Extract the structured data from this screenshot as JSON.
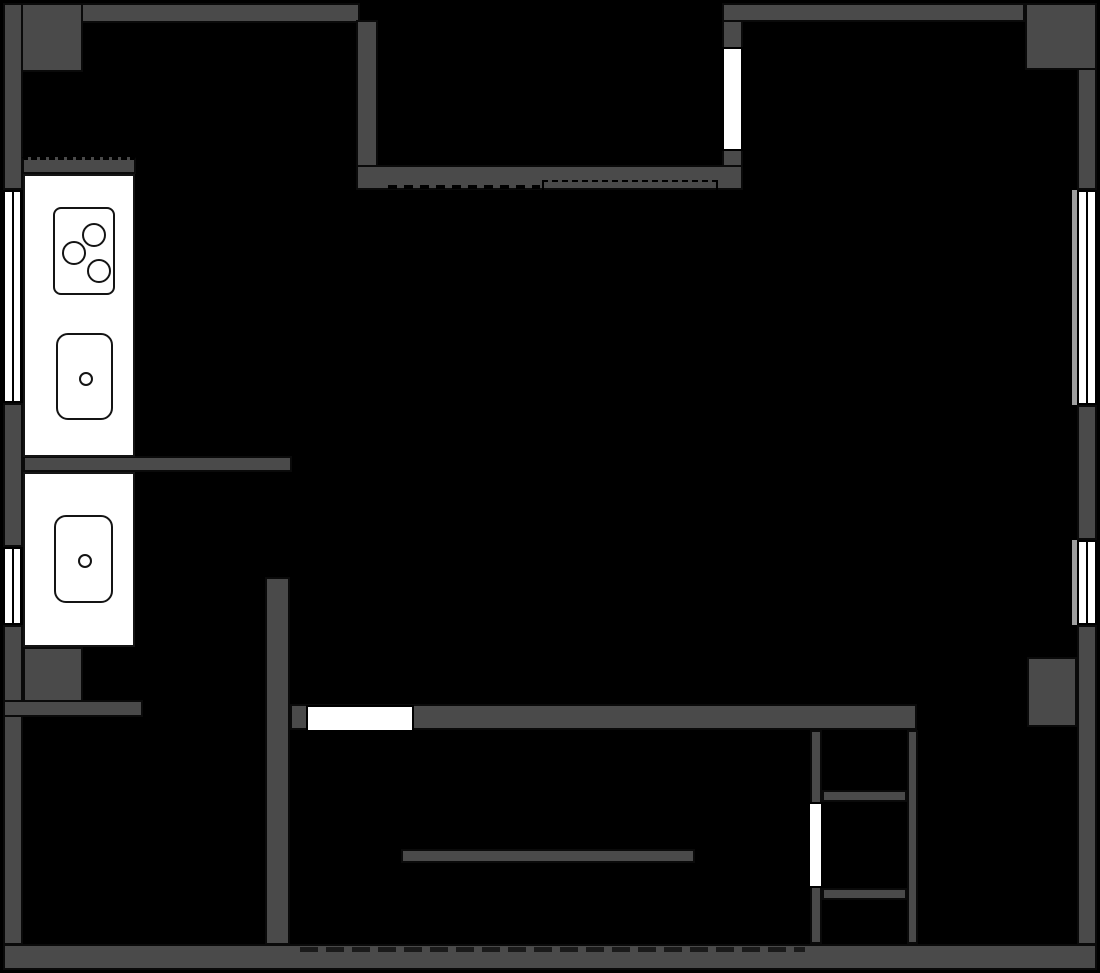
{
  "title": "apartment-floor-plan",
  "canvas": {
    "width": 1100,
    "height": 973
  },
  "palette": {
    "background": "#000000",
    "wall": "#4a4a4a",
    "wall_outline": "#0a0a0a",
    "fixture": "#ffffff",
    "sill": "#9e9e9e",
    "dash": "#1a1a1a"
  },
  "layers": [
    {
      "class": "wall",
      "items": [
        {
          "name": "top-wall-left",
          "x": 3,
          "y": 3,
          "w": 357,
          "h": 20
        },
        {
          "name": "top-left-corner-block",
          "x": 3,
          "y": 3,
          "w": 80,
          "h": 69
        },
        {
          "name": "left-wall-upper",
          "x": 3,
          "y": 3,
          "w": 20,
          "h": 187
        },
        {
          "name": "left-wall-middle",
          "x": 3,
          "y": 403,
          "w": 20,
          "h": 144
        },
        {
          "name": "left-wall-lower",
          "x": 3,
          "y": 625,
          "w": 20,
          "h": 320
        },
        {
          "name": "bottom-wall",
          "x": 3,
          "y": 944,
          "w": 1094,
          "h": 26
        },
        {
          "name": "top-wall-right",
          "x": 722,
          "y": 3,
          "w": 303,
          "h": 19
        },
        {
          "name": "top-right-corner-block",
          "x": 1025,
          "y": 3,
          "w": 72,
          "h": 67
        },
        {
          "name": "right-wall-upper",
          "x": 1077,
          "y": 68,
          "w": 20,
          "h": 122
        },
        {
          "name": "right-wall-middle",
          "x": 1077,
          "y": 405,
          "w": 20,
          "h": 135
        },
        {
          "name": "right-wall-lower",
          "x": 1077,
          "y": 625,
          "w": 20,
          "h": 320
        },
        {
          "name": "recess-left-wall",
          "x": 356,
          "y": 20,
          "w": 22,
          "h": 147
        },
        {
          "name": "recess-bottom-wall",
          "x": 356,
          "y": 165,
          "w": 387,
          "h": 25
        },
        {
          "name": "top-window-wall",
          "x": 722,
          "y": 20,
          "w": 21,
          "h": 147
        },
        {
          "name": "counter-backsplash",
          "x": 22,
          "y": 157,
          "w": 114,
          "h": 17,
          "dash_top": true
        },
        {
          "name": "kitchen-partition-stub",
          "x": 23,
          "y": 456,
          "w": 269,
          "h": 16
        },
        {
          "name": "below-counter-block",
          "x": 23,
          "y": 647,
          "w": 60,
          "h": 70
        },
        {
          "name": "lower-left-room-top-wall",
          "x": 3,
          "y": 700,
          "w": 140,
          "h": 17
        },
        {
          "name": "central-divider-wall",
          "x": 265,
          "y": 577,
          "w": 25,
          "h": 368
        },
        {
          "name": "hall-bottom-wall",
          "x": 290,
          "y": 704,
          "w": 627,
          "h": 26
        },
        {
          "name": "closet-left-wall",
          "x": 810,
          "y": 730,
          "w": 12,
          "h": 214
        },
        {
          "name": "closet-right-wall",
          "x": 907,
          "y": 730,
          "w": 11,
          "h": 214
        },
        {
          "name": "closet-divider-upper",
          "x": 822,
          "y": 790,
          "w": 85,
          "h": 12
        },
        {
          "name": "closet-divider-lower",
          "x": 822,
          "y": 888,
          "w": 85,
          "h": 12
        },
        {
          "name": "right-wall-bump",
          "x": 1027,
          "y": 657,
          "w": 50,
          "h": 70
        },
        {
          "name": "table-bar",
          "x": 401,
          "y": 849,
          "w": 294,
          "h": 14
        }
      ]
    },
    {
      "class": "sill",
      "items": [
        {
          "name": "right-window-sill-upper",
          "x": 1072,
          "y": 190,
          "w": 5,
          "h": 215
        },
        {
          "name": "right-window-sill-lower",
          "x": 1072,
          "y": 540,
          "w": 5,
          "h": 85
        }
      ]
    },
    {
      "class": "dash-strip",
      "items": [
        {
          "name": "recess-dashed-line",
          "x": 388,
          "y": 185,
          "w": 152,
          "h": 4,
          "variant": "fine"
        },
        {
          "name": "bottom-wall-dashed-line",
          "x": 300,
          "y": 947,
          "w": 505,
          "h": 5
        }
      ]
    },
    {
      "class": "dashed-rect",
      "items": [
        {
          "name": "wardrobe-dashed-outline",
          "x": 542,
          "y": 180,
          "w": 176,
          "h": 12
        }
      ]
    },
    {
      "class": "window",
      "items": [
        {
          "name": "left-window-upper",
          "x": 3,
          "y": 190,
          "w": 19,
          "h": 213,
          "divider": "v"
        },
        {
          "name": "left-window-lower",
          "x": 3,
          "y": 547,
          "w": 19,
          "h": 78,
          "divider": "v"
        },
        {
          "name": "right-window-upper",
          "x": 1077,
          "y": 190,
          "w": 20,
          "h": 215,
          "divider": "v"
        },
        {
          "name": "right-window-lower",
          "x": 1077,
          "y": 540,
          "w": 20,
          "h": 85,
          "divider": "v"
        },
        {
          "name": "top-window",
          "x": 722,
          "y": 47,
          "w": 21,
          "h": 104
        }
      ]
    },
    {
      "class": "door",
      "items": [
        {
          "name": "hall-door-opening",
          "x": 306,
          "y": 705,
          "w": 108,
          "h": 27
        },
        {
          "name": "closet-door-opening",
          "x": 808,
          "y": 802,
          "w": 15,
          "h": 86
        }
      ]
    },
    {
      "class": "counter",
      "items": [
        {
          "name": "kitchen-counter-upper",
          "x": 23,
          "y": 174,
          "w": 112,
          "h": 283
        },
        {
          "name": "kitchen-counter-lower",
          "x": 23,
          "y": 472,
          "w": 112,
          "h": 175
        }
      ]
    },
    {
      "class": "appliance",
      "items": [
        {
          "name": "stove",
          "x": 53,
          "y": 207,
          "w": 62,
          "h": 88,
          "r": 8,
          "circles": [
            {
              "name": "burner",
              "cx": 39,
              "cy": 26,
              "r": 12
            },
            {
              "name": "burner",
              "cx": 19,
              "cy": 44,
              "r": 12
            },
            {
              "name": "burner",
              "cx": 44,
              "cy": 62,
              "r": 12
            }
          ]
        },
        {
          "name": "kitchen-sink-upper",
          "x": 56,
          "y": 333,
          "w": 57,
          "h": 87,
          "r": 12,
          "circles": [
            {
              "name": "sink-drain",
              "cx": 28,
              "cy": 44,
              "r": 7
            }
          ]
        },
        {
          "name": "kitchen-sink-lower",
          "x": 54,
          "y": 515,
          "w": 59,
          "h": 88,
          "r": 12,
          "circles": [
            {
              "name": "sink-drain",
              "cx": 29,
              "cy": 44,
              "r": 7
            }
          ]
        }
      ]
    }
  ]
}
